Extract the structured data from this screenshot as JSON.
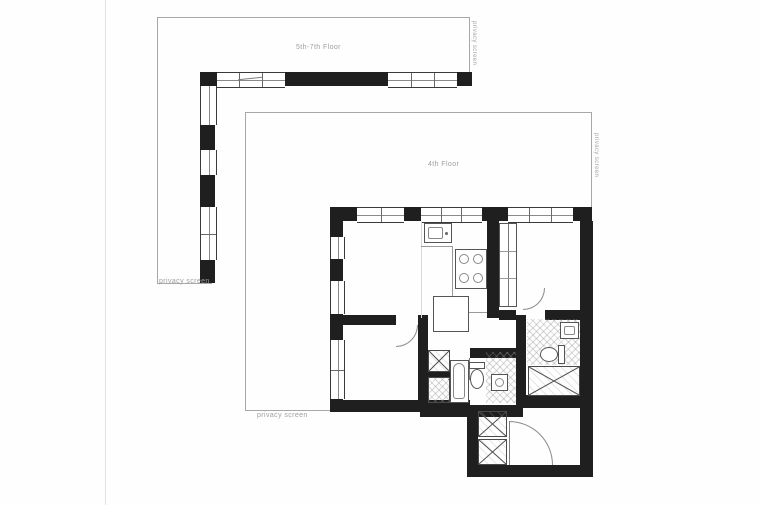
{
  "colors": {
    "background": "#fefefe",
    "wall": "#1f1f1f",
    "outline": "#a8a8a8",
    "fixture_line": "#555555",
    "hatch": "#bdbdbd",
    "label": "#9e9e9e"
  },
  "terrace_5_7": {
    "floor_label": "5th-7th Floor",
    "privacy_screen_side": "privacy screen",
    "privacy_screen_bottom": "privacy screen"
  },
  "floor_4": {
    "floor_label": "4th Floor",
    "privacy_screen_side": "privacy screen",
    "privacy_screen_bottom": "privacy screen"
  },
  "unit": {
    "fixture_icons": [
      "kitchen-sink-icon",
      "stove-icon",
      "fridge-icon",
      "wardrobe-icon",
      "laundry-closet-icon",
      "bathtub-icon",
      "toilet-icon",
      "vanity-sink-icon",
      "ensuite-sink-icon",
      "ensuite-toilet-icon",
      "shower-icon",
      "entry-closet-icon",
      "door-swing-icon"
    ]
  }
}
